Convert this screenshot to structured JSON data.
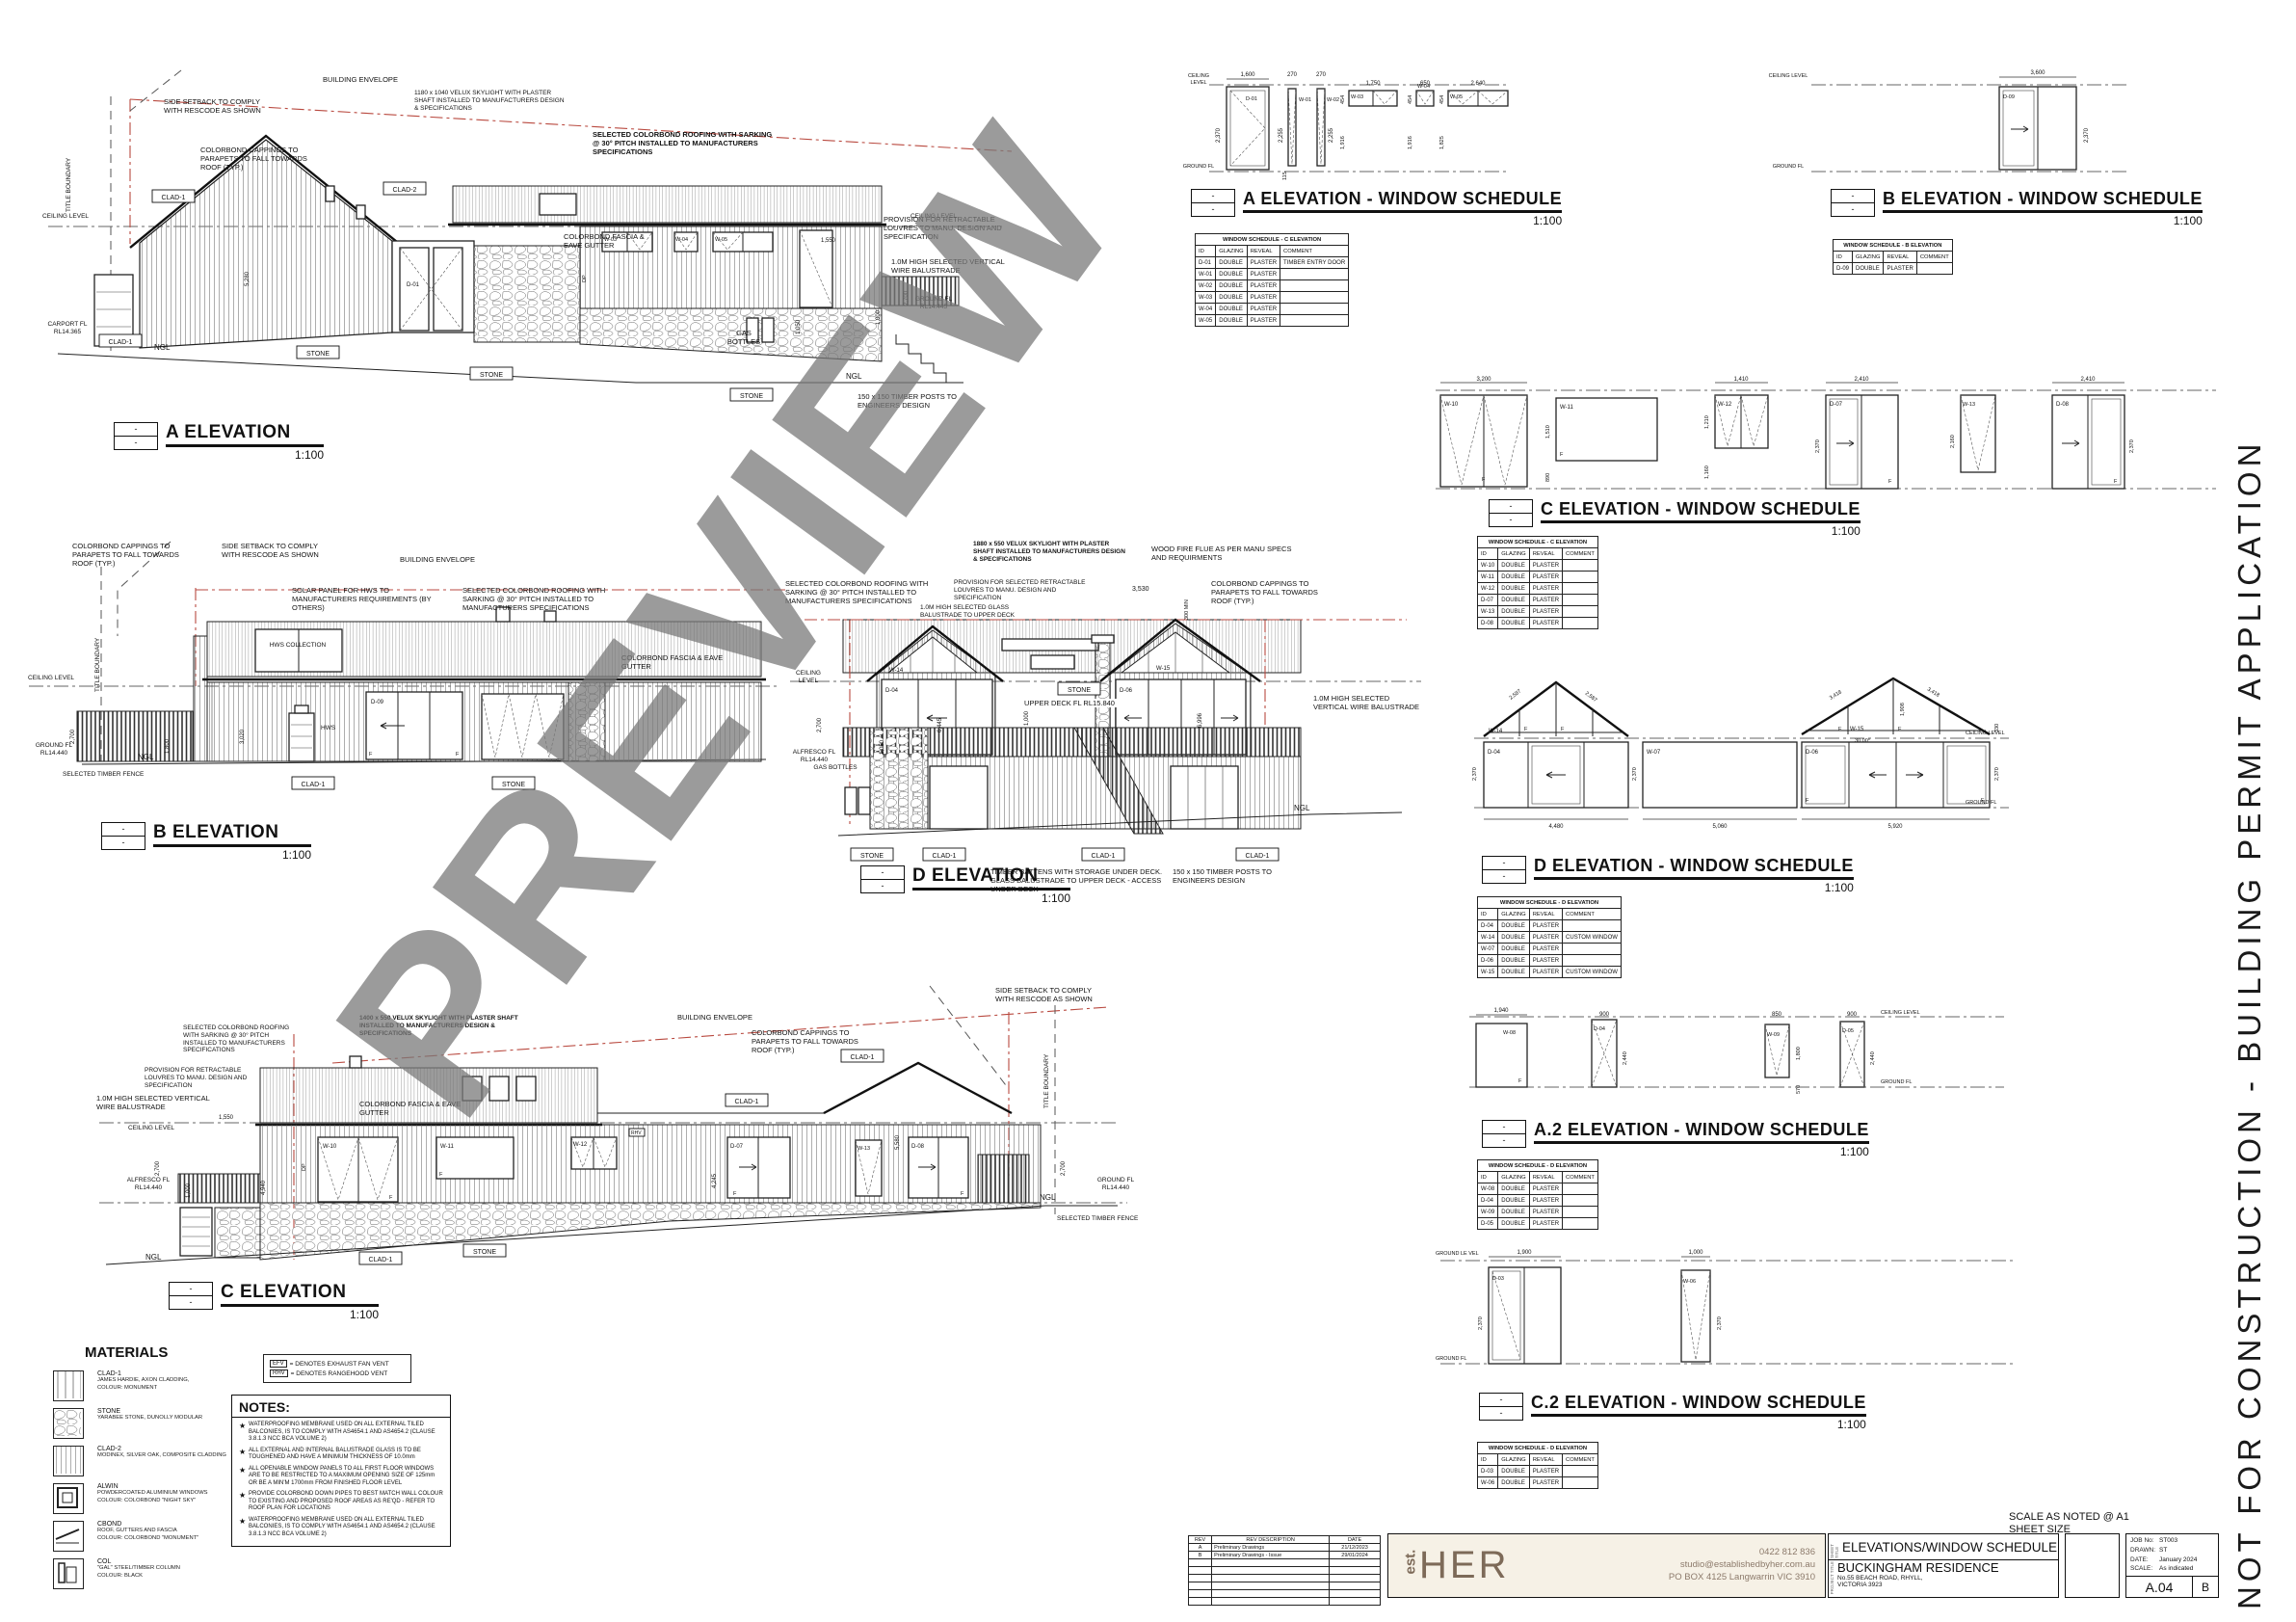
{
  "ui": {
    "dash": "-",
    "scale": "1:100"
  },
  "sheet": {
    "watermark": "PREVIEW",
    "side_text": "NOT FOR CONSTRUCTION  -  BUILDING PERMIT APPLICATION",
    "scale_note": "SCALE AS NOTED @ A1 SHEET SIZE"
  },
  "titles": {
    "a": "A ELEVATION",
    "b": "B ELEVATION",
    "c": "C ELEVATION",
    "d": "D ELEVATION",
    "sa": "A ELEVATION - WINDOW SCHEDULE",
    "sb": "B ELEVATION - WINDOW SCHEDULE",
    "sc": "C ELEVATION - WINDOW SCHEDULE",
    "sd": "D ELEVATION - WINDOW SCHEDULE",
    "sa2": "A.2 ELEVATION - WINDOW SCHEDULE",
    "sc2": "C.2 ELEVATION - WINDOW SCHEDULE"
  },
  "table_headers": [
    "ID",
    "GLAZING",
    "REVEAL",
    "COMMENT"
  ],
  "schedules": {
    "a": {
      "table_title": "WINDOW SCHEDULE - C ELEVATION",
      "rows": [
        {
          "id": "D-01",
          "glazing": "DOUBLE",
          "reveal": "PLASTER",
          "comment": "TIMBER ENTRY DOOR"
        },
        {
          "id": "W-01",
          "glazing": "DOUBLE",
          "reveal": "PLASTER",
          "comment": ""
        },
        {
          "id": "W-02",
          "glazing": "DOUBLE",
          "reveal": "PLASTER",
          "comment": ""
        },
        {
          "id": "W-03",
          "glazing": "DOUBLE",
          "reveal": "PLASTER",
          "comment": ""
        },
        {
          "id": "W-04",
          "glazing": "DOUBLE",
          "reveal": "PLASTER",
          "comment": ""
        },
        {
          "id": "W-05",
          "glazing": "DOUBLE",
          "reveal": "PLASTER",
          "comment": ""
        }
      ]
    },
    "b": {
      "table_title": "WINDOW SCHEDULE - B ELEVATION",
      "rows": [
        {
          "id": "D-09",
          "glazing": "DOUBLE",
          "reveal": "PLASTER",
          "comment": ""
        }
      ]
    },
    "c": {
      "table_title": "WINDOW SCHEDULE - C ELEVATION",
      "rows": [
        {
          "id": "W-10",
          "glazing": "DOUBLE",
          "reveal": "PLASTER",
          "comment": ""
        },
        {
          "id": "W-11",
          "glazing": "DOUBLE",
          "reveal": "PLASTER",
          "comment": ""
        },
        {
          "id": "W-12",
          "glazing": "DOUBLE",
          "reveal": "PLASTER",
          "comment": ""
        },
        {
          "id": "D-07",
          "glazing": "DOUBLE",
          "reveal": "PLASTER",
          "comment": ""
        },
        {
          "id": "W-13",
          "glazing": "DOUBLE",
          "reveal": "PLASTER",
          "comment": ""
        },
        {
          "id": "D-08",
          "glazing": "DOUBLE",
          "reveal": "PLASTER",
          "comment": ""
        }
      ]
    },
    "d": {
      "table_title": "WINDOW SCHEDULE - D ELEVATION",
      "rows": [
        {
          "id": "D-04",
          "glazing": "DOUBLE",
          "reveal": "PLASTER",
          "comment": ""
        },
        {
          "id": "W-14",
          "glazing": "DOUBLE",
          "reveal": "PLASTER",
          "comment": "CUSTOM WINDOW"
        },
        {
          "id": "W-07",
          "glazing": "DOUBLE",
          "reveal": "PLASTER",
          "comment": ""
        },
        {
          "id": "D-06",
          "glazing": "DOUBLE",
          "reveal": "PLASTER",
          "comment": ""
        },
        {
          "id": "W-15",
          "glazing": "DOUBLE",
          "reveal": "PLASTER",
          "comment": "CUSTOM WINDOW"
        }
      ]
    },
    "a2": {
      "table_title": "WINDOW SCHEDULE - D ELEVATION",
      "rows": [
        {
          "id": "W-08",
          "glazing": "DOUBLE",
          "reveal": "PLASTER",
          "comment": ""
        },
        {
          "id": "D-04",
          "glazing": "DOUBLE",
          "reveal": "PLASTER",
          "comment": ""
        },
        {
          "id": "W-09",
          "glazing": "DOUBLE",
          "reveal": "PLASTER",
          "comment": ""
        },
        {
          "id": "D-05",
          "glazing": "DOUBLE",
          "reveal": "PLASTER",
          "comment": ""
        }
      ]
    },
    "c2": {
      "table_title": "WINDOW SCHEDULE - D ELEVATION",
      "rows": [
        {
          "id": "D-03",
          "glazing": "DOUBLE",
          "reveal": "PLASTER",
          "comment": ""
        },
        {
          "id": "W-06",
          "glazing": "DOUBLE",
          "reveal": "PLASTER",
          "comment": ""
        }
      ]
    }
  },
  "materials": {
    "title": "MATERIALS",
    "items": [
      {
        "code": "CLAD-1",
        "desc": "JAMES HARDIE, AXON CLADDING,\nCOLOUR: MONUMENT"
      },
      {
        "code": "STONE",
        "desc": "YARABEE STONE, DUNOLLY MODULAR"
      },
      {
        "code": "CLAD-2",
        "desc": "MODINEX, SILVER OAK, COMPOSITE CLADDING"
      },
      {
        "code": "ALWIN",
        "desc": "POWDERCOATED ALUMINIUM WINDOWS\nCOLOUR: COLORBOND \"NIGHT SKY\""
      },
      {
        "code": "CBOND",
        "desc": "ROOF, GUTTERS AND FASCIA\nCOLOUR: COLORBOND \"MONUMENT\""
      },
      {
        "code": "COL",
        "desc": "\"GAL\" STEEL/TIMBER COLUMN\nCOLOUR: BLACK"
      }
    ]
  },
  "legend": {
    "efv": "EFV",
    "efv_text": "= DENOTES EXHAUST FAN VENT",
    "rhv": "RHV",
    "rhv_text": "= DENOTES RANGEHOOD VENT"
  },
  "notes": {
    "title": "NOTES:",
    "star": "★",
    "items": [
      "WATERPROOFING MEMBRANE USED ON ALL EXTERNAL TILED BALCONIES, IS TO COMPLY WITH AS4654.1 AND AS4654.2 (CLAUSE 3.8.1.3 NCC BCA VOLUME 2)",
      "ALL EXTERNAL AND INTERNAL BALUSTRADE GLASS IS TO BE TOUGHENED AND HAVE A MINIMUM THICKNESS OF 10.0mm",
      "ALL OPENABLE WINDOW PANELS TO ALL FIRST FLOOR WINDOWS ARE TO BE RESTRICTED TO A MAXIMUM OPENING SIZE OF 125mm OR BE A MIN'M 1700mm FROM FINISHED FLOOR LEVEL",
      "PROVIDE COLORBOND DOWN PIPES TO BEST MATCH WALL COLOUR TO EXISTING AND PROPOSED ROOF AREAS AS RE'QD - REFER TO ROOF PLAN FOR LOCATIONS",
      "WATERPROOFING MEMBRANE USED ON ALL EXTERNAL TILED BALCONIES, IS TO COMPLY WITH AS4654.1 AND AS4654.2 (CLAUSE 3.8.1.3 NCC BCA VOLUME 2)"
    ]
  },
  "ann": {
    "ceiling_level": "CEILING LEVEL",
    "ground_fl": "GROUND FL",
    "ground_level": "GROUND LE VEL",
    "ngl": "NGL",
    "dp": "DP",
    "f": "F",
    "title_boundary": "TITLE BOUNDARY",
    "building_envelope": "BUILDING ENVELOPE",
    "side_setback": "SIDE SETBACK TO COMPLY WITH RESCODE AS SHOWN",
    "cappings": "COLORBOND CAPPINGS TO PARAPETS TO FALL TOWARDS ROOF (TYP.)",
    "roofing": "SELECTED COLORBOND ROOFING WITH SARKING @ 30° PITCH INSTALLED TO MANUFACTURERS SPECIFICATIONS",
    "fascia": "COLORBOND FASCIA & EAVE GUTTER",
    "louvres": "PROVISION FOR RETRACTABLE LOUVRES TO MANU. DESIGN AND SPECIFICATION",
    "louvres_sel": "PROVISION FOR SELECTED RETRACTABLE LOUVRES TO MANU. DESIGN AND SPECIFICATION",
    "wire_balustrade": "1.0M HIGH SELECTED VERTICAL WIRE BALUSTRADE",
    "glass_balustrade": "1.0M HIGH SELECTED GLASS BALUSTRADE TO UPPER DECK",
    "timber_posts": "150 x 150 TIMBER POSTS TO ENGINEERS DESIGN",
    "timber_fence": "SELECTED TIMBER FENCE",
    "timber_battens": "TIMBER BATTENS WITH STORAGE UNDER DECK. GLASS BALUSTRADE TO UPPER DECK - ACCESS UNDER DECK",
    "solar": "SOLAR PANEL FOR HWS  TO MANUFACTURERS REQUIREMENTS (BY OTHERS)",
    "hws_collection": "HWS COLLECTION",
    "hws": "HWS",
    "wood_fire": "WOOD FIRE FLUE AS PER MANU SPECS AND REQUIRMENTS",
    "skylight_a": "1180 x 1040 VELUX SKYLIGHT WITH PLASTER SHAFT INSTALLED TO MANUFACTURERS DESIGN & SPECIFICATIONS",
    "skylight_d": "1880 x 550 VELUX SKYLIGHT WITH PLASTER SHAFT INSTALLED TO MANUFACTURERS DESIGN & SPECIFICATIONS",
    "skylight_c": "1400 x 550 VELUX SKYLIGHT WITH PLASTER SHAFT INSTALLED TO MANUFACTURERS DESIGN & SPECIFICATIONS",
    "gas_bottles": "GAS BOTTLES",
    "upper_deck": "UPPER DECK FL RL15.840",
    "carport_fl": "CARPORT FL RL14.365",
    "ground_fl_14440": "GROUND FL RL14.440",
    "ground_fl_14445": "GROUND FL RL14.445",
    "alfresco_fl": "ALFRESCO FL RL14.440",
    "clad1": "CLAD-1",
    "clad2": "CLAD-2",
    "stone": "STONE"
  },
  "wid": {
    "d01": "D-01",
    "d03": "D-03",
    "d04": "D-04",
    "d05": "D-05",
    "d06": "D-06",
    "d07": "D-07",
    "d08": "D-08",
    "d09": "D-09",
    "w01": "W-01",
    "w02": "W-02",
    "w03": "W-03",
    "w04": "W-04",
    "w05": "W-05",
    "w06": "W-06",
    "w07": "W-07",
    "w08": "W-08",
    "w09": "W-09",
    "w10": "W-10",
    "w11": "W-11",
    "w12": "W-12",
    "w13": "W-13",
    "w14": "W-14",
    "w15": "W-15"
  },
  "dim": {
    "d115": "115",
    "d270": "270",
    "d330": "330",
    "d454": "454",
    "d570": "570",
    "d650": "650",
    "d850": "850",
    "d890": "890",
    "d900": "900",
    "d1000": "1,000",
    "d1050": "1,050",
    "d1160": "1,160",
    "d1210": "1,210",
    "d1410": "1,410",
    "d1510": "1,510",
    "d1550": "1,550",
    "d1600": "1,600",
    "d1750": "1,750",
    "d1800": "1,800",
    "d1825": "1,825",
    "d1900": "1,900",
    "d1908": "1,908",
    "d1916": "1,916",
    "d1940": "1,940",
    "d2160": "2,160",
    "d2255": "2,255",
    "d2370": "2,370",
    "d2410": "2,410",
    "d2440": "2,440",
    "d2587": "2,587",
    "d2640": "2,640",
    "d2700": "2,700",
    "d3020": "3,020",
    "d3200": "3,200",
    "d3418": "3,418",
    "d3530": "3,530",
    "d3600": "3,600",
    "d4245": "4,245",
    "d4480": "4,480",
    "d4940": "4,940",
    "d5060": "5,060",
    "d5280": "5,280",
    "d5580": "5,580",
    "d5920": "5,920",
    "d6445": "6,445",
    "d6996": "6,996",
    "deg30": "30.00°",
    "min300": "300 MIN"
  },
  "title_block": {
    "rev_headers": [
      "REV",
      "REV DESCRIPTION",
      "DATE"
    ],
    "revisions": [
      {
        "rev": "A",
        "desc": "Preliminary Drawings",
        "date": "21/12/2023"
      },
      {
        "rev": "B",
        "desc": "Preliminary Drawings - Issue",
        "date": "29/01/2024"
      }
    ],
    "logo_est": "est.",
    "logo_her": "HER",
    "phone": "0422 812 836",
    "email": "studio@establishedbyher.com.au",
    "address": "PO BOX 4125 Langwarrin VIC 3910",
    "sheet_title_label": "SHEET TITLE",
    "project_title_label": "PROJECT TITLE",
    "sheet_title": "ELEVATIONS/WINDOW SCHEDULE",
    "project_title": "BUCKINGHAM RESIDENCE",
    "project_addr1": "No.55 BEACH ROAD, RHYLL,",
    "project_addr2": "VICTORIA 3923",
    "job_label": "JOB No:",
    "job_value": "ST003",
    "drawn_label": "DRAWN:",
    "drawn_value": "ST",
    "date_label": "DATE:",
    "date_value": "January 2024",
    "scale_label": "SCALE:",
    "scale_value": "As indicated",
    "sheet_no": "A.04",
    "sheet_rev": "B"
  }
}
